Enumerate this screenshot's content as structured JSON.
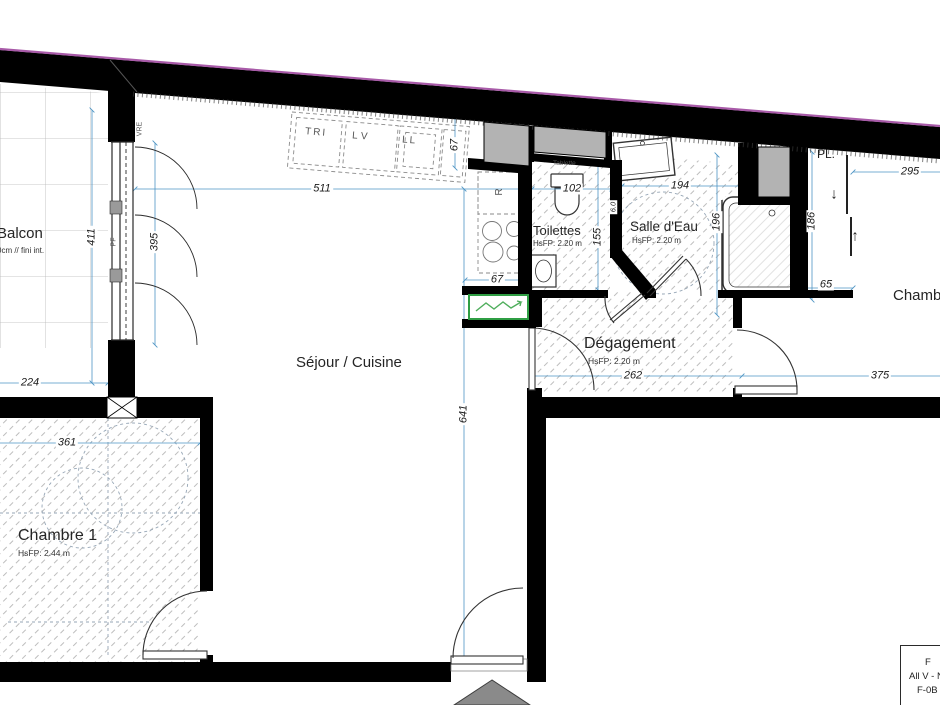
{
  "plan": {
    "rooms": {
      "balcon": {
        "name": "Balcon",
        "note": "0cm // fini int."
      },
      "sejour": {
        "name": "Séjour / Cuisine"
      },
      "toilettes": {
        "name": "Toilettes",
        "hsfp": "HsFP: 2.20 m"
      },
      "salle_eau": {
        "name": "Salle d'Eau",
        "hsfp": "HsFP: 2.20 m"
      },
      "degagement": {
        "name": "Dégagement",
        "hsfp": "HsFP: 2.20 m"
      },
      "chambre1": {
        "name": "Chambre 1",
        "hsfp": "HsFP: 2.44 m"
      },
      "chambre2": {
        "name": "Chambre"
      },
      "placard": {
        "name": "PL."
      }
    },
    "kitchen": {
      "tri": "TRI",
      "lv": "LV",
      "ll": "LL",
      "fridge": "R"
    },
    "fixtures": {
      "shelf": "Tablette"
    },
    "window_labels": {
      "pf": "PF",
      "vre": "VRE"
    },
    "arrows": {
      "down": "↓",
      "up": "↑"
    },
    "dimensions": {
      "d511": "511",
      "d411": "411",
      "d395": "395",
      "d224": "224",
      "d361": "361",
      "d641": "641",
      "d67_kitchen": "67",
      "d67_counter": "67",
      "d102": "102",
      "d155": "155",
      "d194": "194",
      "d196": "196",
      "d6": "6.0",
      "d186": "186",
      "d295": "295",
      "d65": "65",
      "d262": "262",
      "d375": "375"
    },
    "title_block": {
      "line1": "F",
      "line2": "All V - N",
      "line3": "F-0B"
    },
    "colors": {
      "wall": "#000000",
      "dimension": "#4d94c4",
      "shaft": "#b3b3b3",
      "electric": "#2f9e44",
      "slab_edge": "#a85aa8"
    }
  }
}
